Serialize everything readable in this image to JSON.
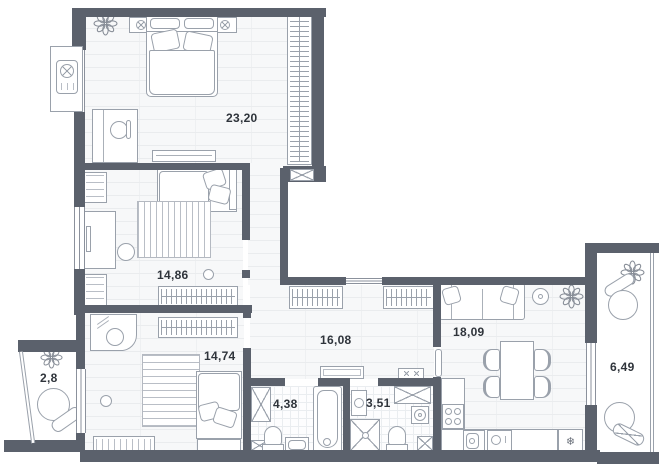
{
  "title": "apartment-floor-plan",
  "rooms": {
    "bedroom": {
      "area_label": "23,20"
    },
    "bedroom2": {
      "area_label": "14,86"
    },
    "bedroom3": {
      "area_label": "14,74"
    },
    "hallway": {
      "area_label": "16,08"
    },
    "living_kitchen": {
      "area_label": "18,09"
    },
    "bathroom": {
      "area_label": "4,38"
    },
    "wc": {
      "area_label": "3,51"
    },
    "balcony_left": {
      "area_label": "2,8"
    },
    "balcony_right": {
      "area_label": "6,49"
    }
  },
  "icons": {
    "fridge_snowflake": "❄"
  },
  "colors": {
    "wall": "#5b616c",
    "furniture_line": "#9aa1ab",
    "label_text": "#2f343b",
    "floor": "#f7f8f9"
  }
}
